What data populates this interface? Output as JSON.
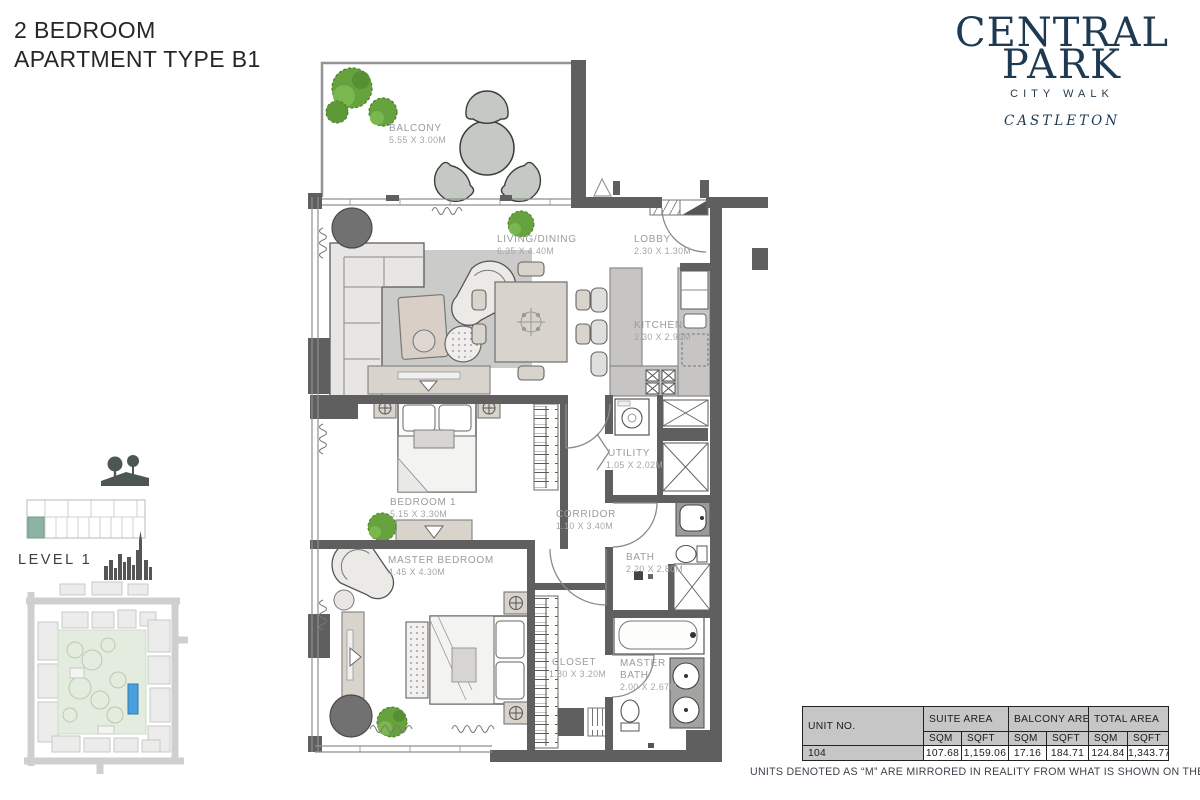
{
  "title": {
    "line1": "2 BEDROOM",
    "line2": "APARTMENT TYPE B1"
  },
  "brand": {
    "line1": "CENTRAL",
    "line2": "PARK",
    "subtitle": "CITY WALK",
    "project": "CASTLETON"
  },
  "level": {
    "label": "LEVEL 1"
  },
  "rooms": {
    "balcony": {
      "name": "BALCONY",
      "dims": "5.55 X 3.00M"
    },
    "living": {
      "name": "LIVING/DINING",
      "dims": "6.35 X 4.40M"
    },
    "lobby": {
      "name": "LOBBY",
      "dims": "2.30 X 1.30M"
    },
    "kitchen": {
      "name": "KITCHEN",
      "dims": "2.30 X 2.90M"
    },
    "utility": {
      "name": "UTILITY",
      "dims": "1.05 X 2.02M"
    },
    "bedroom1": {
      "name": "BEDROOM 1",
      "dims": "5.15 X 3.30M"
    },
    "corridor": {
      "name": "CORRIDOR",
      "dims": "1.10 X 3.40M"
    },
    "bath": {
      "name": "BATH",
      "dims": "2.20 X 2.80M"
    },
    "master_bedroom": {
      "name": "MASTER BEDROOM",
      "dims": "4.45 X 4.30M"
    },
    "closet": {
      "name": "CLOSET",
      "dims": "1.80 X 3.20M"
    },
    "master_bath": {
      "name_line1": "MASTER",
      "name_line2": "BATH",
      "dims": "2.00 X 2.67M"
    }
  },
  "table": {
    "unit_no_label": "UNIT NO.",
    "suite_area_label": "SUITE AREA",
    "balcony_area_label": "BALCONY AREA",
    "total_area_label": "TOTAL AREA",
    "sqm_label": "SQM",
    "sqft_label": "SQFT",
    "row": {
      "unit": "104",
      "suite_sqm": "107.68",
      "suite_sqft": "1,159.06",
      "balcony_sqm": "17.16",
      "balcony_sqft": "184.71",
      "total_sqm": "124.84",
      "total_sqft": "1,343.77"
    }
  },
  "footnote": {
    "text": "UNITS DENOTED AS “M” ARE MIRRORED IN REALITY FROM WHAT IS SHOWN ON THE PLAN"
  },
  "colors": {
    "brand_navy": "#1e3a52",
    "wall_gray": "#5f5f5f",
    "level_highlight_teal": "#8db3a3",
    "sitemap_highlight_blue": "#4aa0dc"
  }
}
